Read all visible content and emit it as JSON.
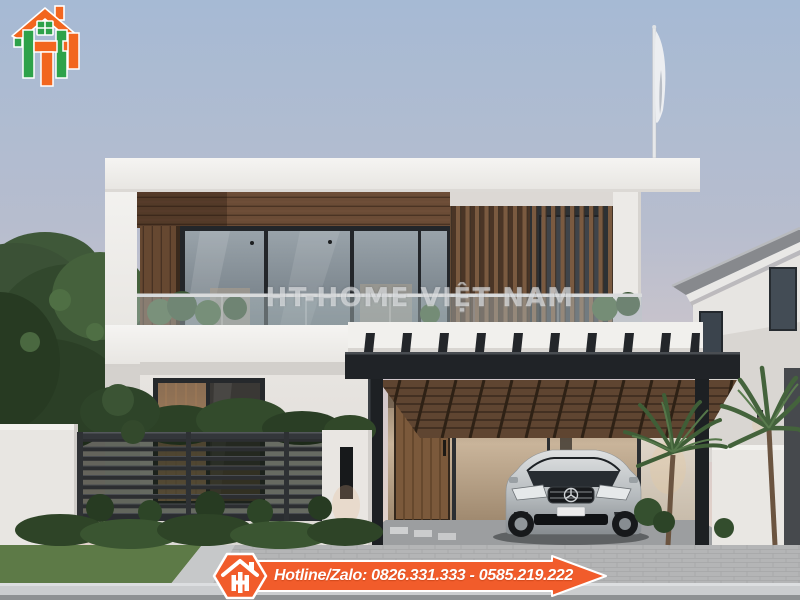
{
  "watermark": {
    "text": "HT-HOME VIỆT NAM"
  },
  "hotline_banner": {
    "text": "Hotline/Zalo: 0826.331.333 - 0585.219.222",
    "background_color": "#f15c2b",
    "border_color": "#ffffff"
  },
  "logo": {
    "name": "ht-home-logo",
    "orange_color": "#f2661f",
    "green_color": "#2ea24a"
  },
  "scene_palette": {
    "sky_top": "#a6bad4",
    "sky_horizon": "#e4d5cd",
    "structure_white": "#f2f1ee",
    "wood_brown": "#6b4c36",
    "pergola_black": "#212428",
    "car_silver": "#ccd0d2"
  }
}
